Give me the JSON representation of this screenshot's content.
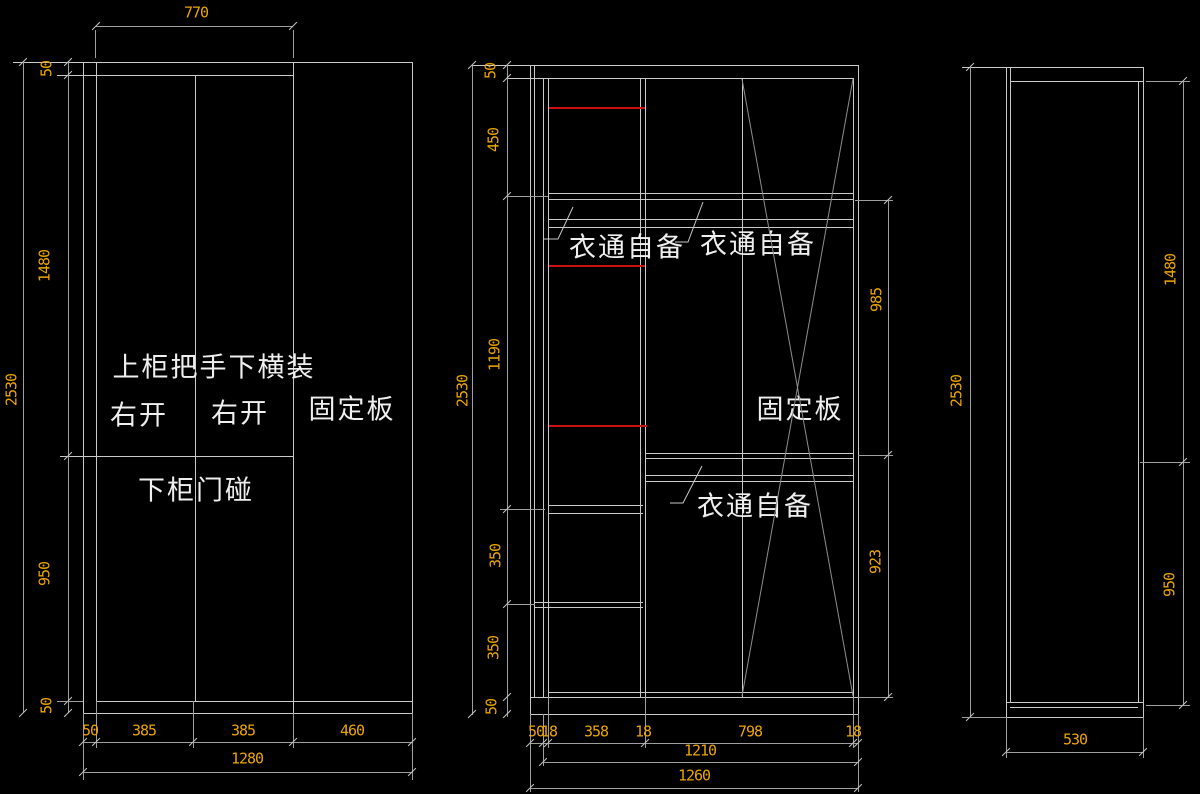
{
  "colors": {
    "background": "#000000",
    "line": "#c9c9c9",
    "dim_line": "#9f9f9f",
    "dim_text": "#eda500",
    "red_accent": "#cc1111",
    "label_text": "#efefef",
    "diagonal": "#8e8e8e"
  },
  "front_view": {
    "top_width": "770",
    "height_overall": "2530",
    "height_segments": [
      "50",
      "1480",
      "950",
      "50"
    ],
    "bottom_segments": [
      "50",
      "385",
      "385",
      "460"
    ],
    "bottom_overall": "1280",
    "labels": {
      "handle_note": "上柜把手下横装",
      "door_left": "右开",
      "door_right": "右开",
      "fixed_panel": "固定板",
      "lower_door_note": "下柜门碰"
    }
  },
  "internal_view": {
    "height_overall": "2530",
    "height_segments": [
      "50",
      "450",
      "1190",
      "350",
      "350",
      "50"
    ],
    "right_segments": [
      "985",
      "923"
    ],
    "bottom_segments": [
      "50",
      "18",
      "358",
      "18",
      "798",
      "18"
    ],
    "bottom_inner": "1210",
    "bottom_overall": "1260",
    "labels": {
      "rod_note_left": "衣通自备",
      "rod_note_right": "衣通自备",
      "rod_note_lower": "衣通自备",
      "fixed_panel": "固定板"
    }
  },
  "side_view": {
    "height_overall": "2530",
    "right_segments": [
      "1480",
      "950"
    ],
    "bottom_width": "530"
  }
}
